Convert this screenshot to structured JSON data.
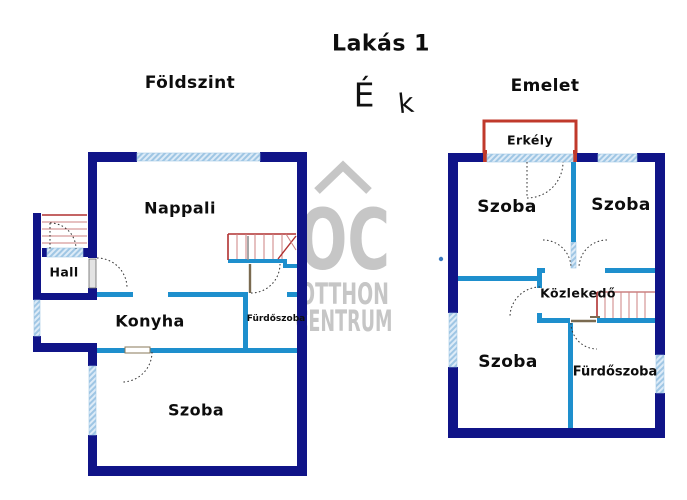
{
  "page_title": "Lakás 1",
  "compass": {
    "north": "É",
    "direction_k": "k"
  },
  "watermark": {
    "logo": "OC",
    "name_line1": "OTTHON",
    "name_line2": "CENTRUM"
  },
  "ground_floor": {
    "title": "Földszint",
    "rooms": {
      "nappali": "Nappali",
      "hall": "Hall",
      "konyha": "Konyha",
      "furdoszoba": "Fürdőszoba",
      "szoba": "Szoba"
    }
  },
  "upper_floor": {
    "title": "Emelet",
    "rooms": {
      "erkely": "Erkély",
      "szoba_top_left": "Szoba",
      "szoba_top_right": "Szoba",
      "kozlekedo": "Közlekedő",
      "szoba_bottom": "Szoba",
      "furdoszoba": "Fürdőszoba"
    }
  },
  "colors": {
    "exterior_wall": "#101488",
    "interior_wall": "#1e8fcd",
    "stairs_red": "#b03030",
    "stairs_light_red": "#cc8080",
    "balcony_red": "#c0392b",
    "window_blue": "#9fc6e4",
    "watermark_gray": "#c6c6c6",
    "door_sill_brown": "#7a6a50",
    "text": "#0d0d0d"
  }
}
